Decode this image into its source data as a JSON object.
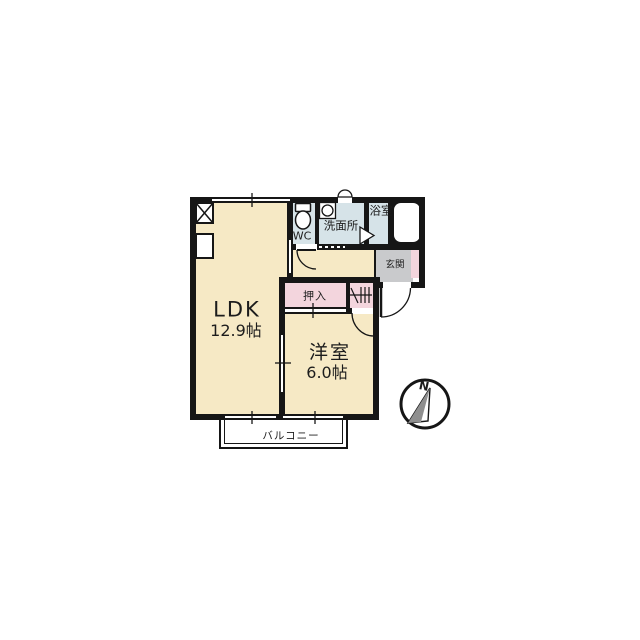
{
  "plan": {
    "rooms": {
      "ldk": {
        "name": "LDK",
        "size": "12.9帖"
      },
      "western_room": {
        "name": "洋室",
        "size": "6.0帖"
      },
      "wc": {
        "name": "WC"
      },
      "washroom": {
        "name": "洗面所"
      },
      "bathroom": {
        "name": "浴室"
      },
      "entrance": {
        "name": "玄関"
      },
      "closet": {
        "name": "押入"
      },
      "balcony": {
        "name": "バルコニー"
      }
    },
    "compass": {
      "north": "N"
    },
    "colors": {
      "room": "#F6E9C5",
      "wet": "#D6E3E8",
      "pink": "#F3D5DD",
      "entrance_gray": "#C9CACC",
      "wall": "#161616"
    }
  }
}
